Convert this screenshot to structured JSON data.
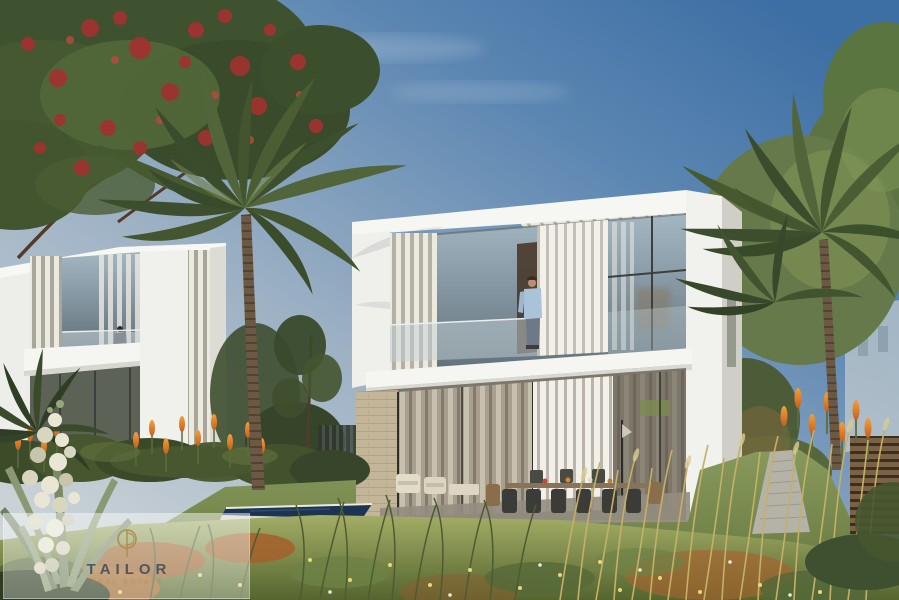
{
  "meta": {
    "title": "Modern two-storey villas exterior rendering with palm garden",
    "canvas_width": 899,
    "canvas_height": 600
  },
  "watermark": {
    "brand": "TAILOR",
    "tagline": "REAL ESTATE",
    "logo_icon": "gold-needle-circle-monogram",
    "panel_color": "rgba(245,248,244,0.45)",
    "gold": "#a8893f",
    "text_color": "#47505a"
  },
  "scene": {
    "objects": [
      "sky",
      "cirrus-clouds",
      "flame-tree-red-blossoms",
      "center-palm",
      "right-palms",
      "left-villa",
      "main-villa",
      "man-on-balcony",
      "woman-on-balcony",
      "pergola-slats",
      "vertical-louvers",
      "stone-clad-wall",
      "curtained-glass-doors",
      "outdoor-dining-set",
      "lounge-chairs",
      "swimming-pool",
      "lawn",
      "wildflower-meadow",
      "kniphofia-orange-flowers",
      "yucca-white-blossoms",
      "stone-path",
      "wooden-slat-fence",
      "distant-building"
    ]
  },
  "palette": {
    "sky_deep_blue": "#3e6fa4",
    "sky_pale": "#cfd6d9",
    "villa_white": "#f5f5f1",
    "louver_gray": "#b3b0a6",
    "glass_reflection": "#9db2c0",
    "stone_beige": "#c3b698",
    "foliage_dark": "#3c4e2d",
    "foliage_light": "#6f8148",
    "lawn_green": "#7d9150",
    "meadow_olive": "#8c9a57",
    "rust_grass": "#a65f2c",
    "kniphofia_orange": "#d9782e",
    "pool_navy": "#1c3452",
    "blossom_red": "#9e3330",
    "yucca_cream": "#e9e6d4",
    "fence_brown": "#7c6244"
  }
}
